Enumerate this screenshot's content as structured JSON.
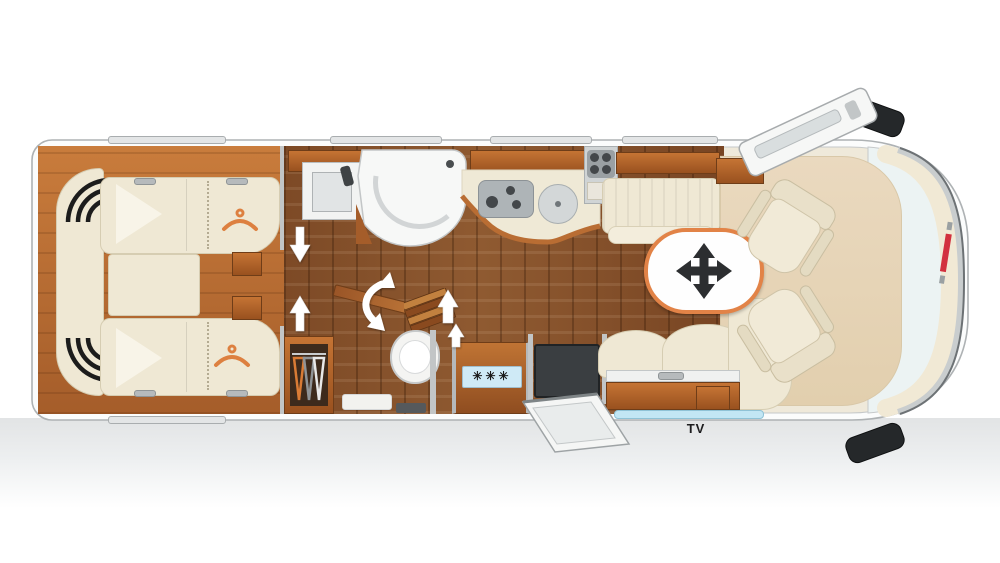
{
  "floorplan": {
    "title": "motorhome-floorplan-top-view",
    "labels": {
      "tv": "TV",
      "freezer_snowflakes": "✳✳✳"
    },
    "colors": {
      "body_shell": "#ecf3f3",
      "wall_gray": "#c2c5c6",
      "wood_furniture": "#c0702f",
      "wood_floor": "#8a5732",
      "upholstery_cream": "#efe8d4",
      "accent_orange": "#e28347",
      "freezer_label_bg": "#cfeaf6",
      "tv_screen_blue": "#c2e6f4",
      "mirror_black": "#25282a",
      "brand_logo_red": "#d2303e",
      "entry_step_mat": "#3a3e41",
      "window_gray": "#e3e5e6",
      "ground_shadow": "#e2e4e5"
    },
    "icons": {
      "table-move-icon": "four-way cross arrows",
      "bed-hanger-icon": "clothes hanger (wardrobe under bed)",
      "wardrobe-hangers-icon": "three clothes hangers on rail",
      "door-swing-arrow-icon": "white directional arrow",
      "door-swing-curved-arrow-icon": "white curved double arrow",
      "freezer-snowflake-icon": "snowflake asterisks",
      "side-mirror-icon": "vehicle side mirror"
    }
  }
}
